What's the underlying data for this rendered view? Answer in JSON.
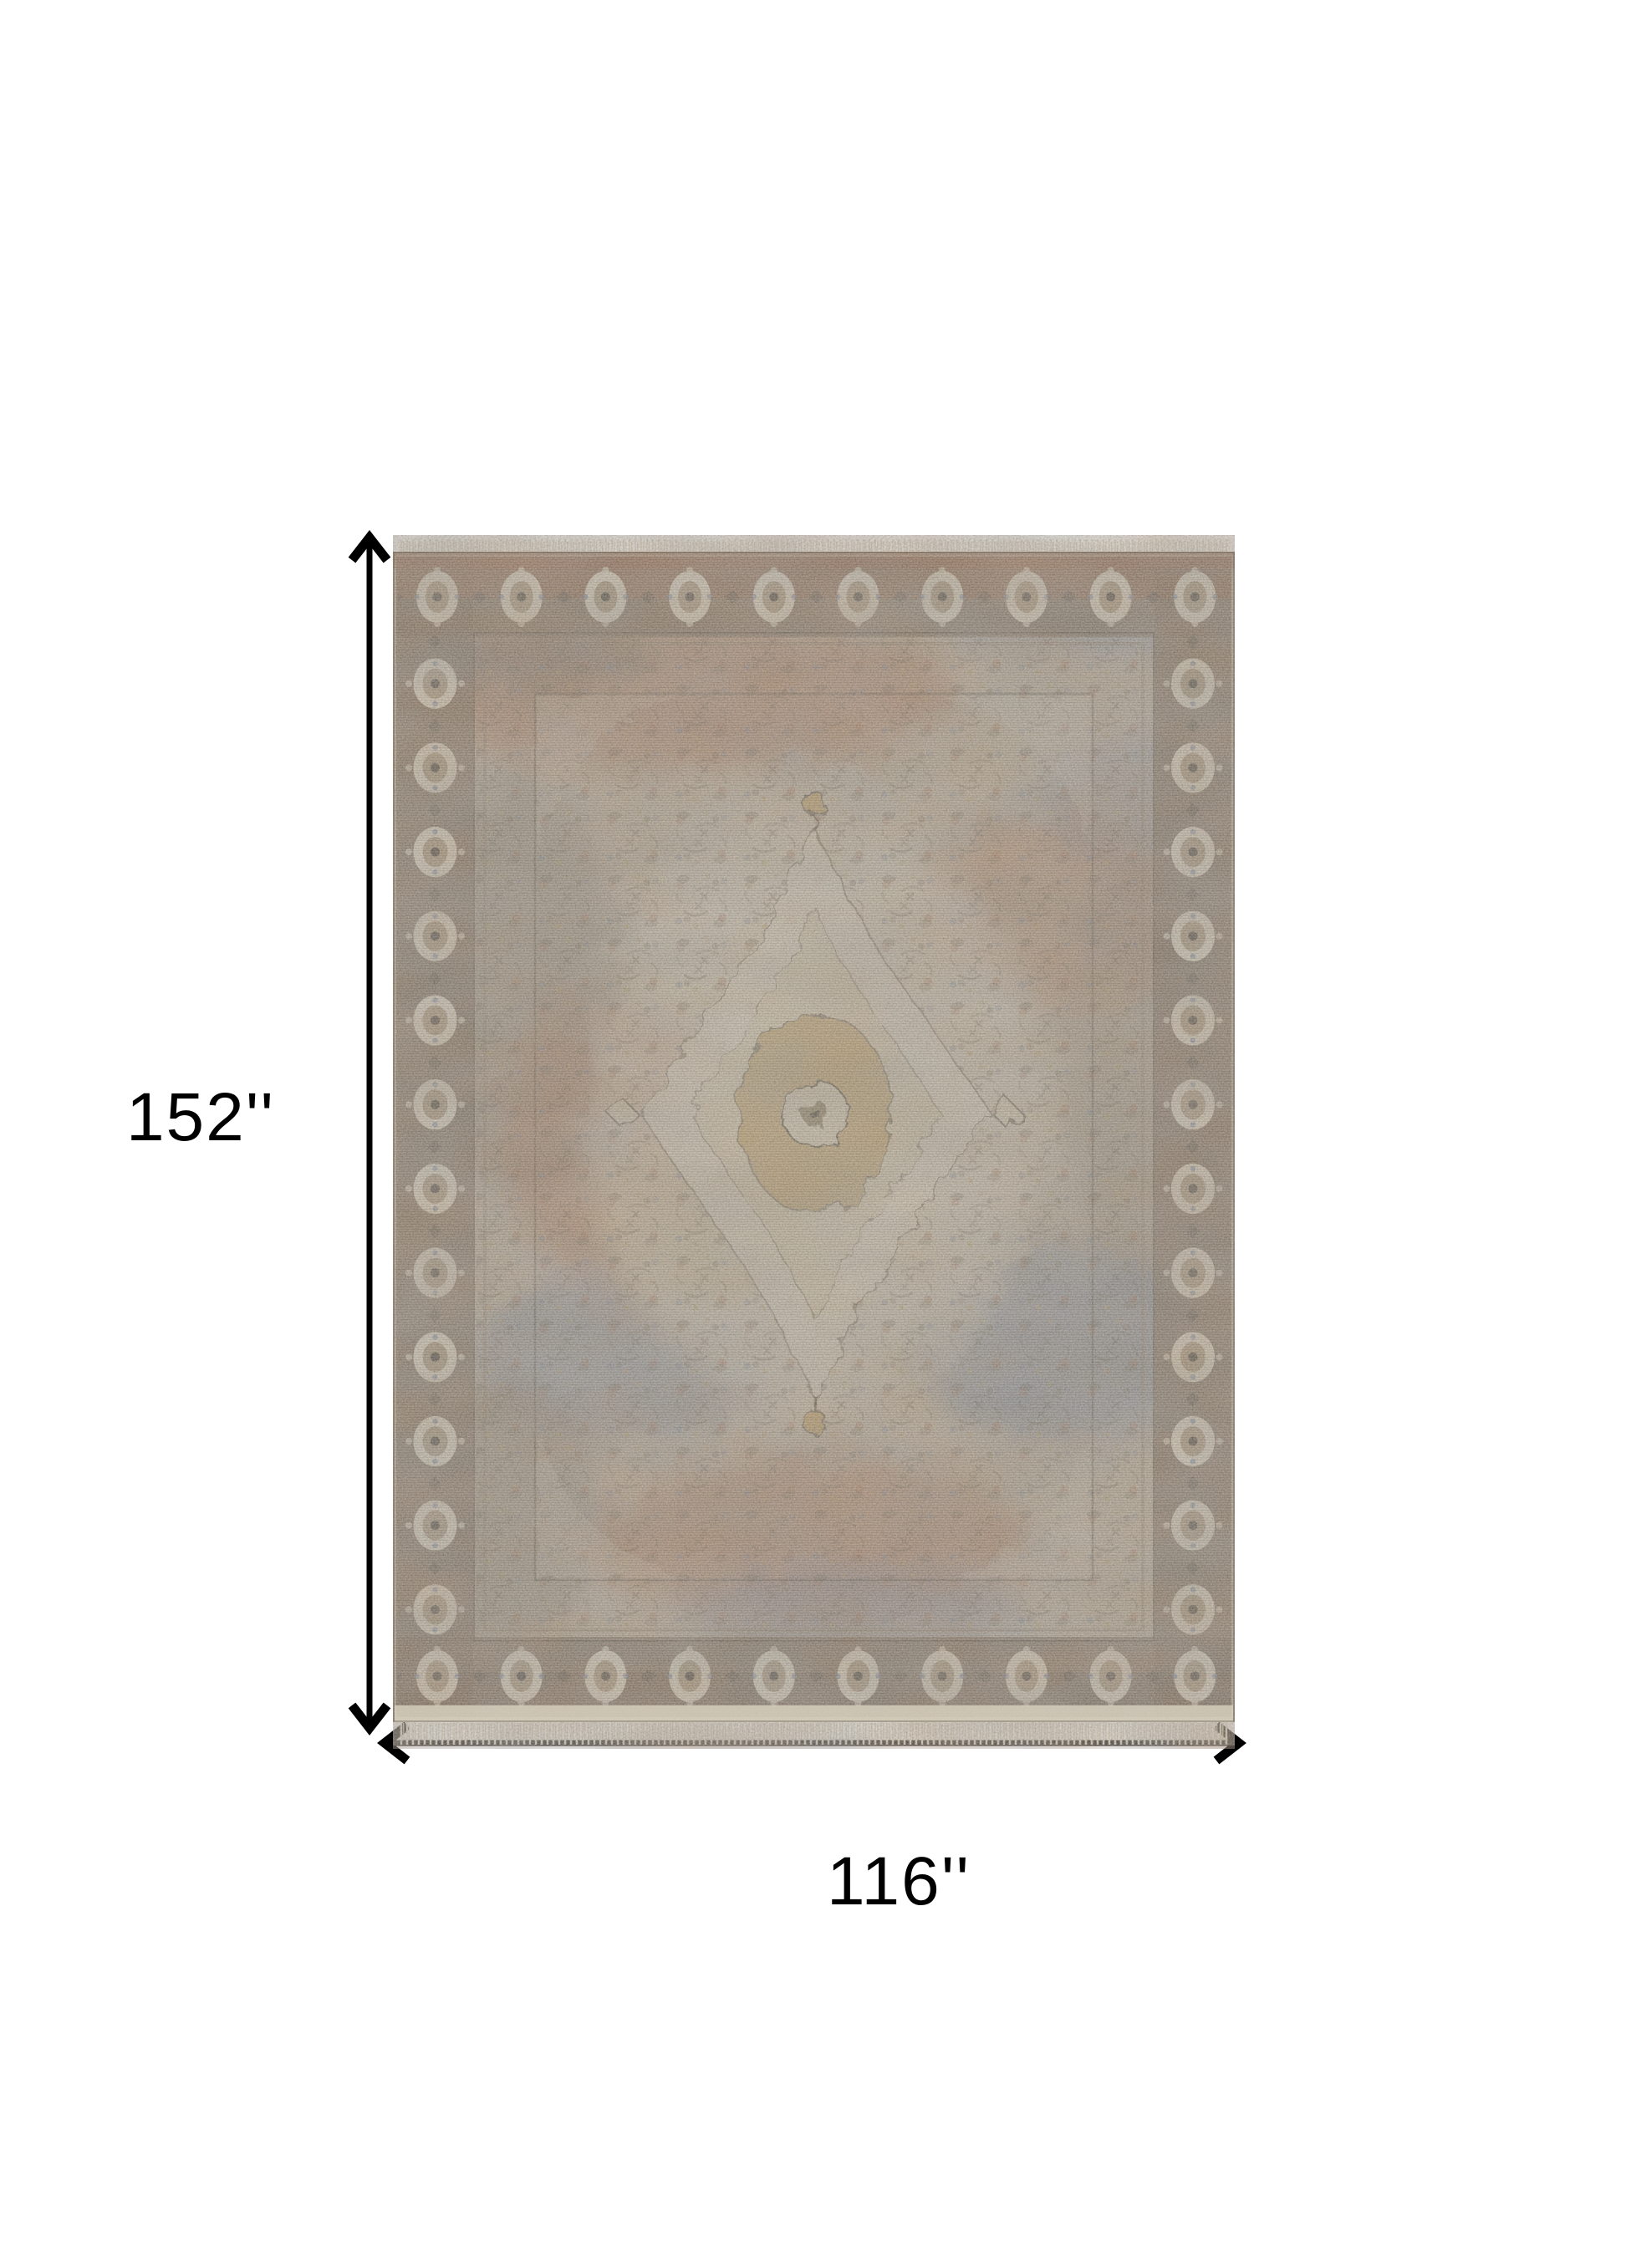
{
  "image": {
    "type": "product-dimension-diagram",
    "description": "Distressed oriental-style medallion area rug shown flat on white, annotated with height and width dimension arrows",
    "background": "#ffffff"
  },
  "dimensions": {
    "height_label": "152''",
    "width_label": "116''",
    "height_value": 152,
    "width_value": 116,
    "unit": "inches"
  },
  "rug": {
    "style": "vintage distressed oriental medallion",
    "has_fringe": true,
    "border": "dark brown band with cream rosette medallions",
    "field": "mottled tan, rust, slate blue and gray with pale center medallion"
  },
  "colors": {
    "arrow": "#000000",
    "label": "#000000",
    "rug_base": "#b7ab97",
    "rug_cream": "#d6cfbc",
    "rug_border_band": "#6a5947",
    "rug_border_rust": "#8c4f33",
    "rug_rust": "#9e5e3e",
    "rug_blue": "#5f7294",
    "rug_gold": "#b3914f",
    "rug_gray": "#6e665a",
    "rug_dark": "#4a4337",
    "rug_medallion": "#d6cfbc",
    "fringe": "#e7e0cd"
  }
}
